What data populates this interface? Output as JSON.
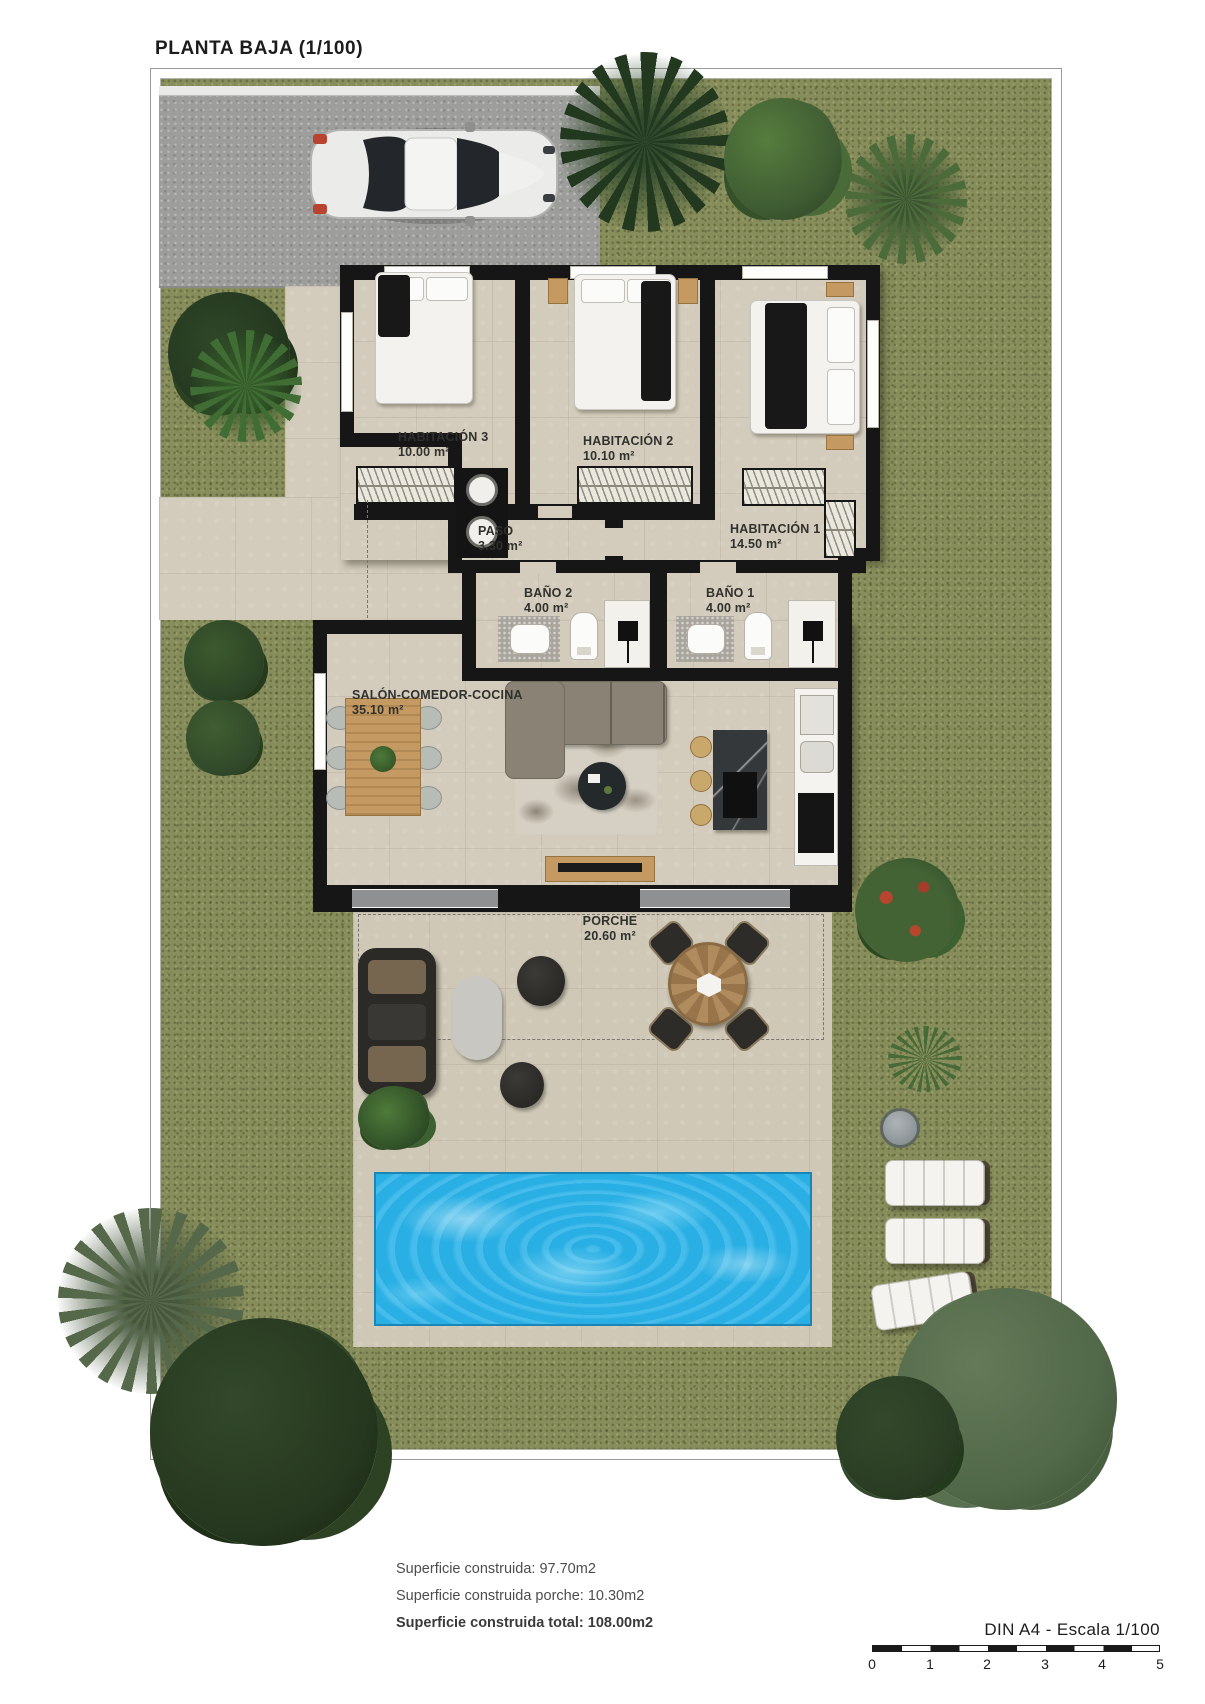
{
  "title": "PLANTA BAJA (1/100)",
  "rooms": [
    {
      "name": "HABITACIÓN 3",
      "area": "10.00 m²"
    },
    {
      "name": "HABITACIÓN 2",
      "area": "10.10 m²"
    },
    {
      "name": "HABITACIÓN 1",
      "area": "14.50 m²"
    },
    {
      "name": "PASO",
      "area": "3.30 m²"
    },
    {
      "name": "BAÑO 2",
      "area": "4.00 m²"
    },
    {
      "name": "BAÑO 1",
      "area": "4.00 m²"
    },
    {
      "name": "SALÓN-COMEDOR-COCINA",
      "area": "35.10 m²"
    },
    {
      "name": "PORCHE",
      "area": "20.60 m²"
    }
  ],
  "annotations": {
    "line1": "Superficie construida: 97.70m2",
    "line2": "Superficie construida porche: 10.30m2",
    "line3": "Superficie construida total: 108.00m2"
  },
  "scale": {
    "label": "DIN A4 - Escala 1/100",
    "ticks": [
      "0",
      "1",
      "2",
      "3",
      "4",
      "5"
    ]
  },
  "colors": {
    "grass": "#878d5b",
    "floor": "#d3ccbc",
    "wall": "#161616",
    "pool": "#2bb3e8",
    "driveway": "#9d9d9b"
  }
}
